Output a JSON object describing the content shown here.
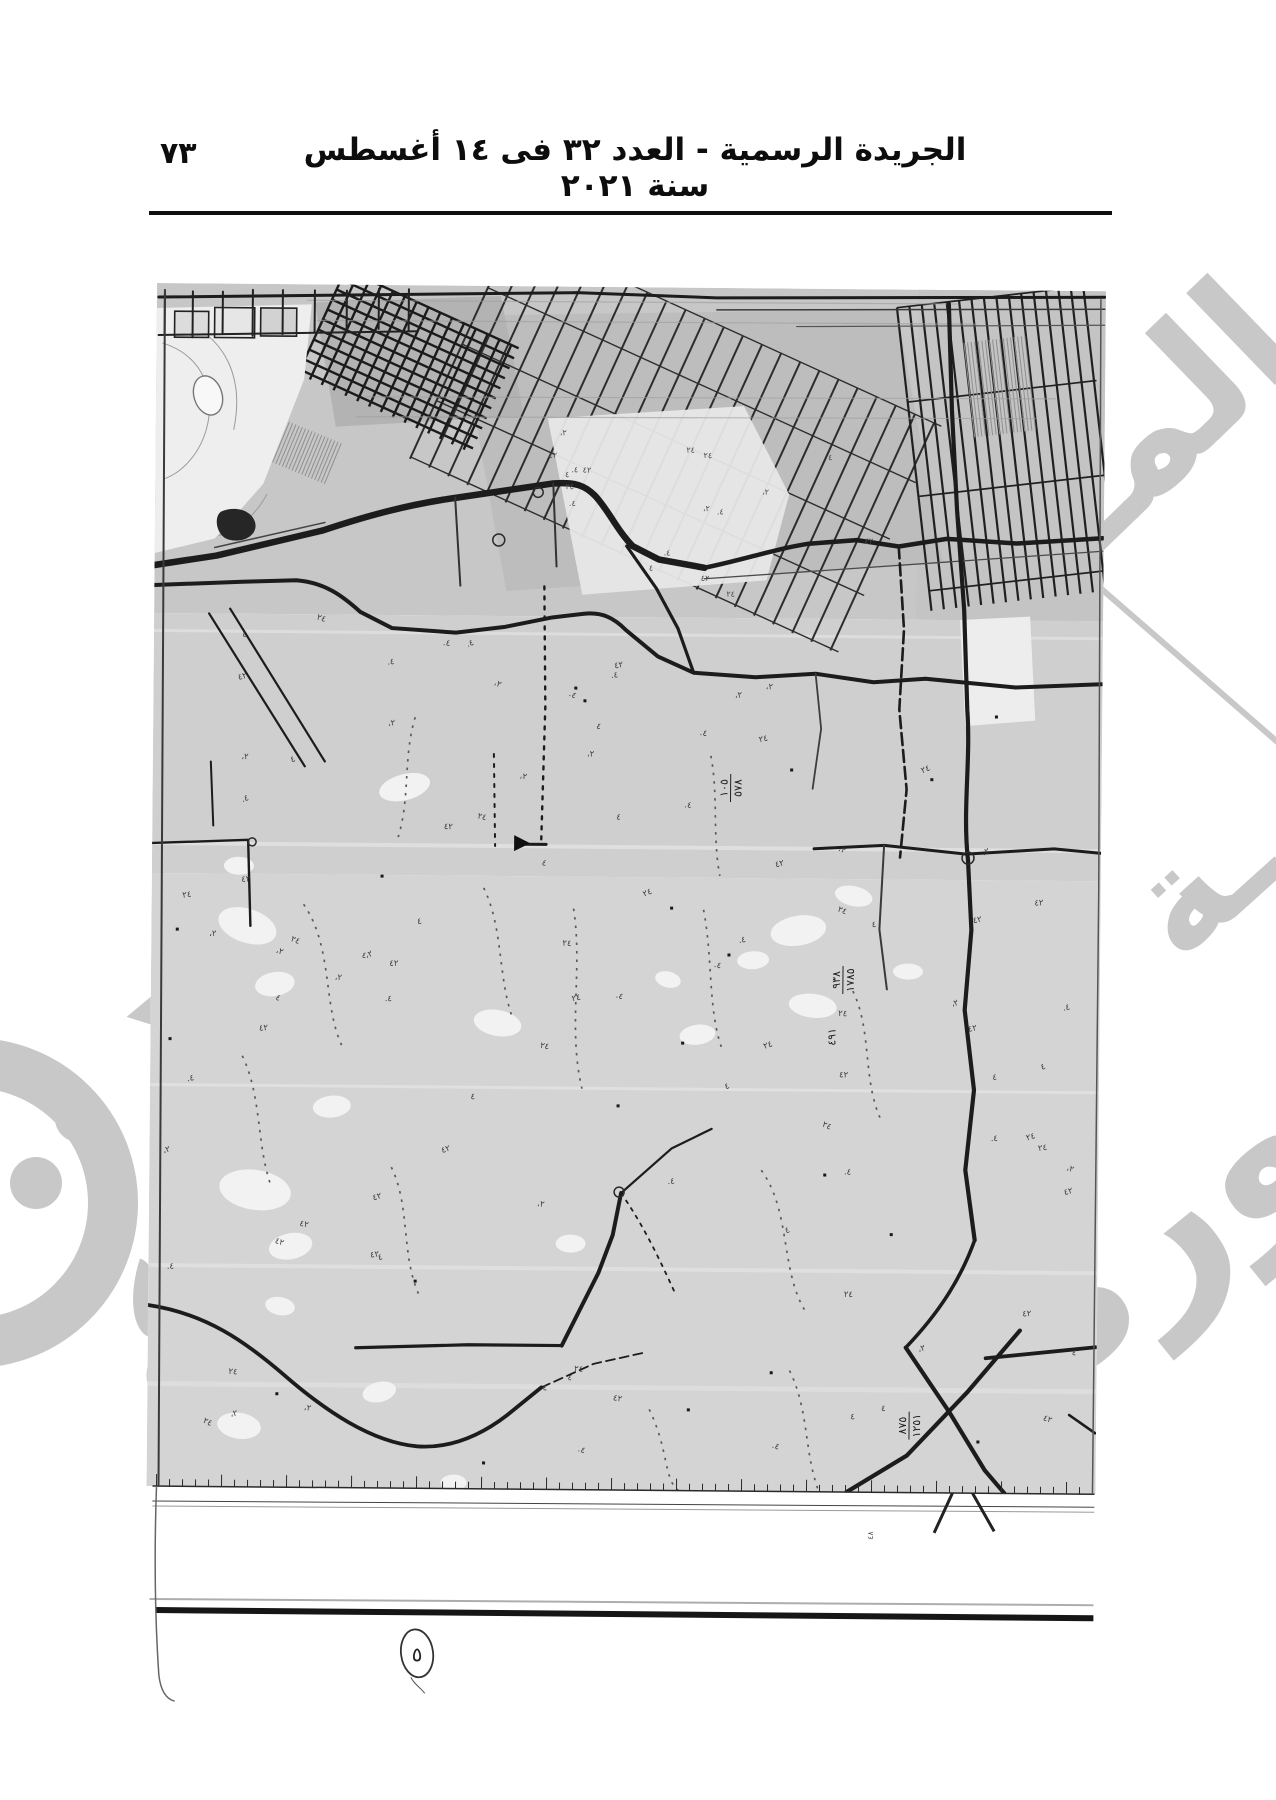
{
  "header": {
    "title": "الجريدة الرسمية - العدد ٣٢ فى ١٤ أغسطس سنة ٢٠٢١",
    "page_number": "٧٣"
  },
  "map": {
    "description": "scanned-cadastral-survey-map",
    "road_labels": [
      {
        "num": "١٠٥",
        "den": "٥٧٨",
        "x": 578,
        "y": 500
      },
      {
        "num": "٩٣٨",
        "den": "١٧٨٥",
        "x": 692,
        "y": 691
      },
      {
        "num": "٤٩١",
        "den": "",
        "x": 688,
        "y": 748
      },
      {
        "num": "٨٧٥",
        "den": "١٢٥١",
        "x": 762,
        "y": 1136
      }
    ],
    "margin_note": "٥",
    "ruler_note": "٤٨",
    "scatter_glyphs": [
      "٤٢",
      "٤.",
      "٢٤",
      "٤",
      "٢،"
    ],
    "colors": {
      "paper": "#ffffff",
      "map_base": "#d4d4d4",
      "map_top_band": "#c7c7c7",
      "ink": "#1a1a1a",
      "watermark": "#c8c8c8"
    }
  },
  "watermark": {
    "fragment_top_right": "المـ",
    "fragment_tail": "ـة",
    "fragment_bottom_right": "صورة"
  }
}
